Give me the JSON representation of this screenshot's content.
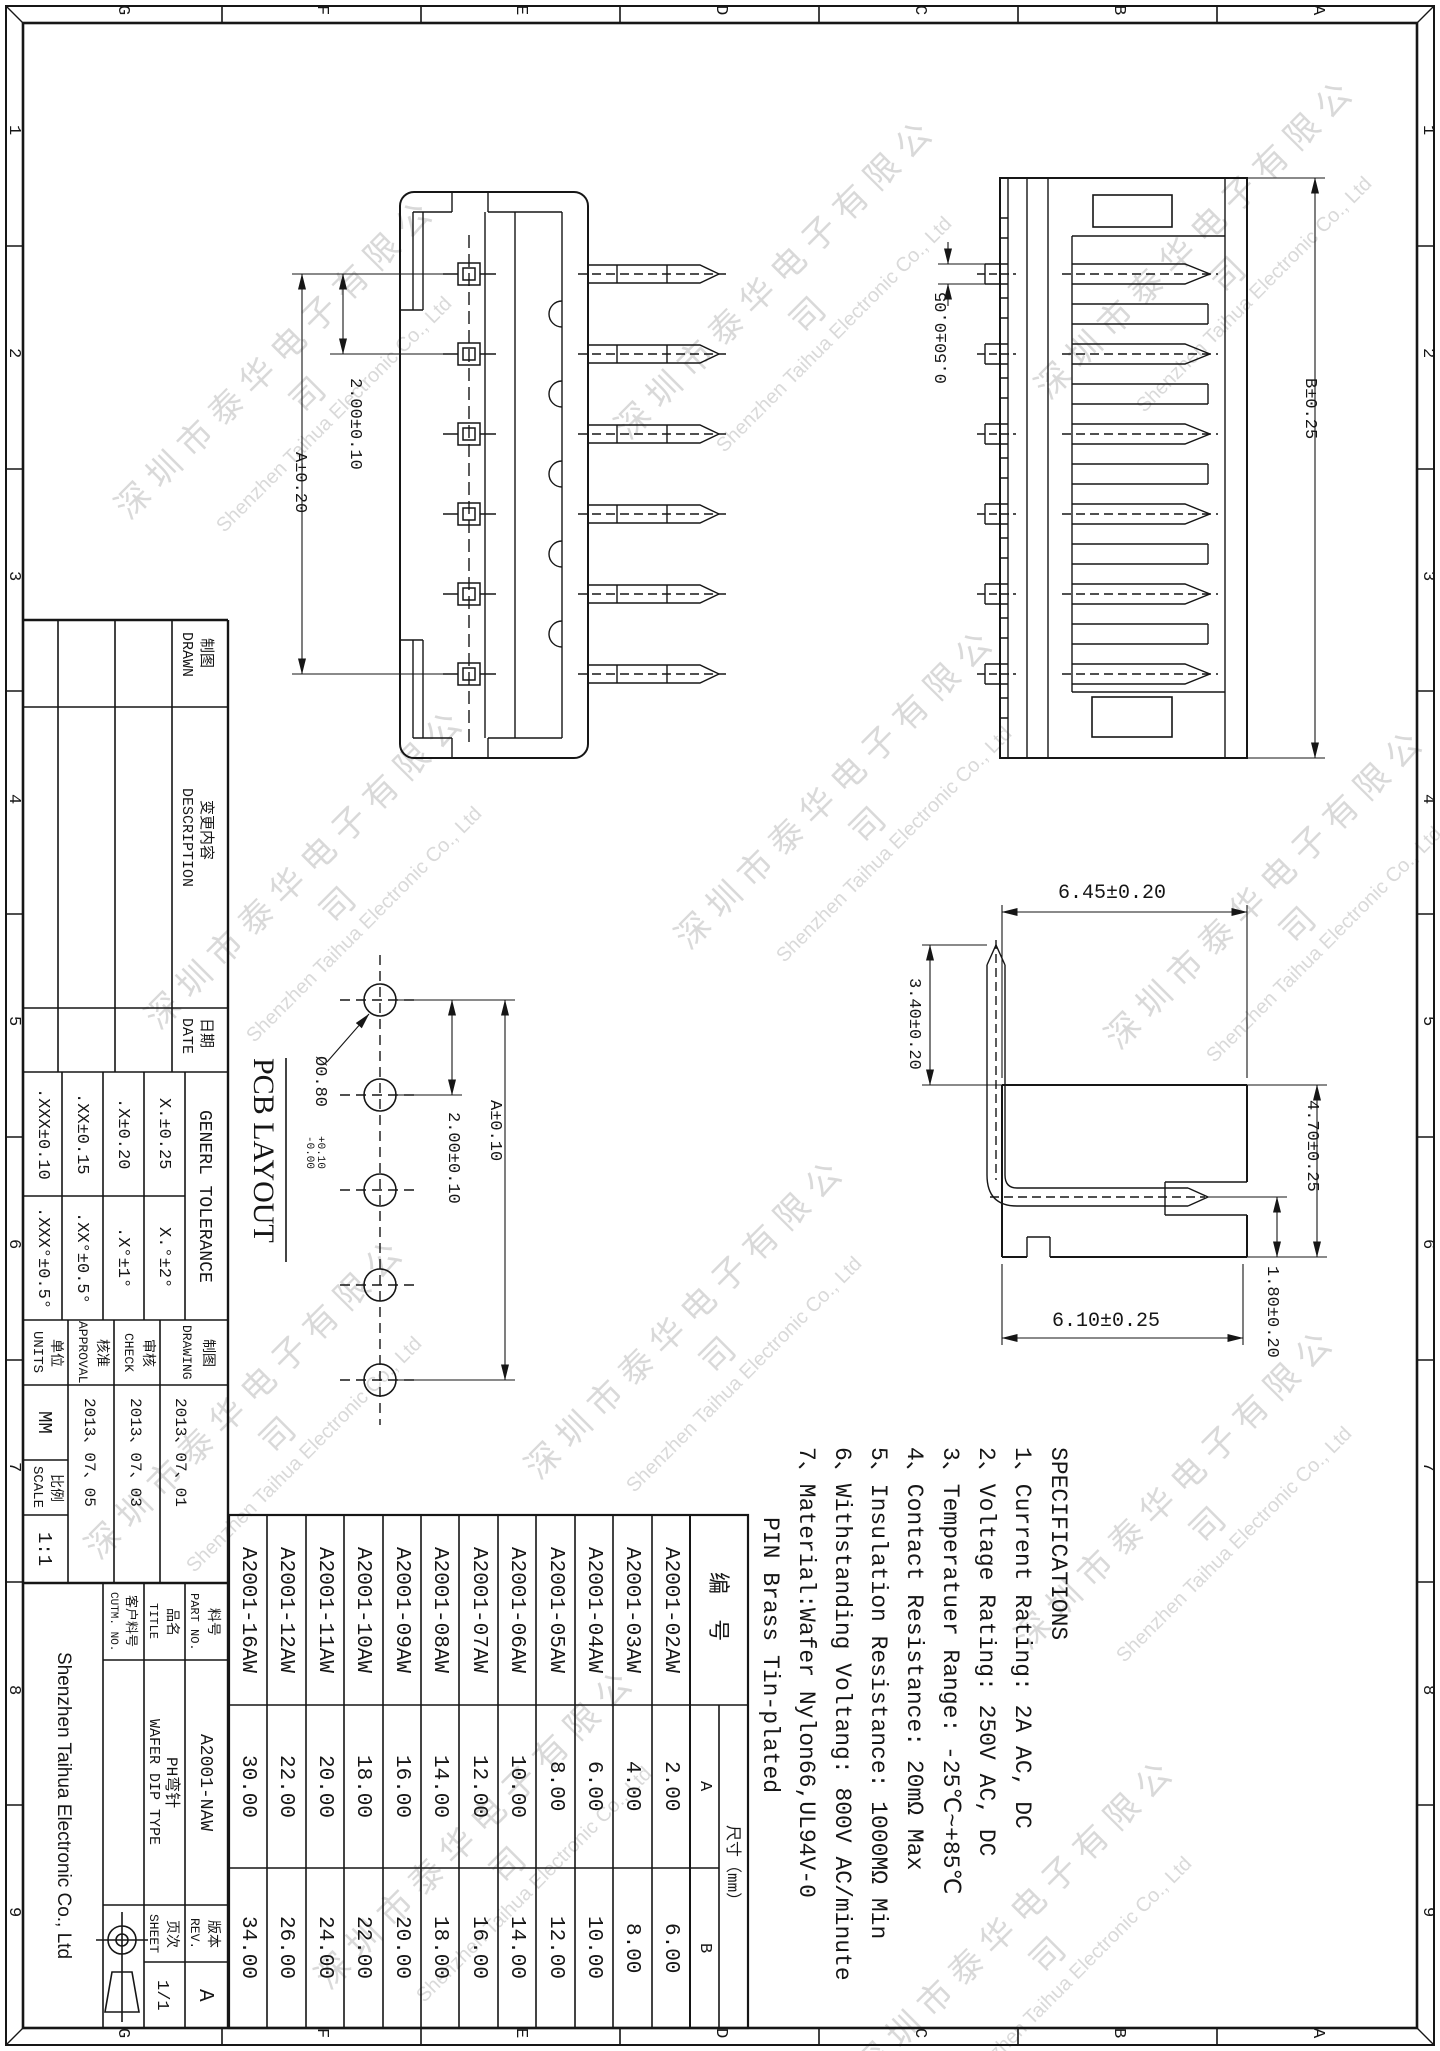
{
  "border": {
    "letters": [
      "G",
      "F",
      "E",
      "D",
      "C",
      "B",
      "A"
    ],
    "numbers": [
      "1",
      "2",
      "3",
      "4",
      "5",
      "6",
      "7",
      "8",
      "9"
    ]
  },
  "watermark": {
    "cn": "深圳市泰华电子有限公司",
    "en": "Shenzhen Taihua Electronic Co., Ltd"
  },
  "views": {
    "pcb_title": "PCB LAYOUT",
    "dims": {
      "front_pitch": "2.00±0.10",
      "front_overall": "A±0.20",
      "tab_width": "0.50±0.05",
      "top_overall": "B±0.25",
      "profile_width": "6.45±0.20",
      "pin_height": "3.40±0.20",
      "body_height": "4.70±0.25",
      "tail_length": "1.80±0.20",
      "bottom_width": "6.10±0.25",
      "pcb_pitch": "2.00±0.10",
      "pcb_overall": "A±0.10",
      "hole_dia": "Ø0.80",
      "hole_tol": "+0.10\n-0.00"
    }
  },
  "revision": {
    "drawn_cn": "制图",
    "drawn_en": "DRAWN",
    "description_cn": "变更内容",
    "description_en": "DESCRIPTION",
    "date_cn": "日期",
    "date_en": "DATE"
  },
  "tolerance": {
    "title": "GENERL TOLERANCE",
    "linear": [
      ".XXX±0.10",
      ".XX±0.15",
      ".X±0.20",
      "X.±0.25"
    ],
    "angular": [
      ".XXX°±0.5°",
      ".XX°±0.5°",
      ".X°±1°",
      "X.°±2°"
    ]
  },
  "approvals": {
    "units_cn": "单位",
    "units_en": "UNITS",
    "units_value": "MM",
    "scale_cn": "比例",
    "scale_en": "SCALE",
    "scale_value": "1:1",
    "approval_cn": "核准",
    "approval_en": "APPROVAL",
    "approval_date": "2013、07、05",
    "check_cn": "审核",
    "check_en": "CHECK",
    "check_date": "2013、07、03",
    "drawing_cn": "制图",
    "drawing_en": "DRAWING",
    "drawing_date": "2013、07、01"
  },
  "title_block": {
    "company": "Shenzhen Taihua Electronic Co., Ltd",
    "part_no_cn": "料号",
    "part_no_en": "PART NO.",
    "part_no": "A2001-NAW",
    "title_cn": "品名",
    "title_en": "TITLE",
    "product_cn": "PH弯针",
    "product_en": "WAFER DIP TYPE",
    "cutm_cn": "客户料号",
    "cutm_en": "CUTM. NO.",
    "rev_cn": "版本",
    "rev_en": "REV.",
    "rev_value": "A",
    "sheet_cn": "页次",
    "sheet_en": "SHEET",
    "sheet_value": "1/1"
  },
  "specs": {
    "title": "SPECIFICATIONS",
    "items": [
      "1、Current Rating: 2A AC, DC",
      "2、Voltage Rating: 250V AC, DC",
      "3、Temperatuer Range: -25℃~+85℃",
      "4、Contact Resistance: 20mΩ Max",
      "5、Insulation Resistance: 1000MΩ Min",
      "6、Withstanding Voltang: 800V AC/minute",
      "7、Material:Wafer Nylon66,UL94V-0"
    ],
    "note": "PIN Brass Tin-plated"
  },
  "parts_table": {
    "header": "编 号",
    "dim_header": "尺寸（mm）",
    "col_a": "A",
    "col_b": "B",
    "rows": [
      {
        "part": "A2001-02AW",
        "a": "2.00",
        "b": "6.00"
      },
      {
        "part": "A2001-03AW",
        "a": "4.00",
        "b": "8.00"
      },
      {
        "part": "A2001-04AW",
        "a": "6.00",
        "b": "10.00"
      },
      {
        "part": "A2001-05AW",
        "a": "8.00",
        "b": "12.00"
      },
      {
        "part": "A2001-06AW",
        "a": "10.00",
        "b": "14.00"
      },
      {
        "part": "A2001-07AW",
        "a": "12.00",
        "b": "16.00"
      },
      {
        "part": "A2001-08AW",
        "a": "14.00",
        "b": "18.00"
      },
      {
        "part": "A2001-09AW",
        "a": "16.00",
        "b": "20.00"
      },
      {
        "part": "A2001-10AW",
        "a": "18.00",
        "b": "22.00"
      },
      {
        "part": "A2001-11AW",
        "a": "20.00",
        "b": "24.00"
      },
      {
        "part": "A2001-12AW",
        "a": "22.00",
        "b": "26.00"
      },
      {
        "part": "A2001-16AW",
        "a": "30.00",
        "b": "34.00"
      }
    ]
  }
}
